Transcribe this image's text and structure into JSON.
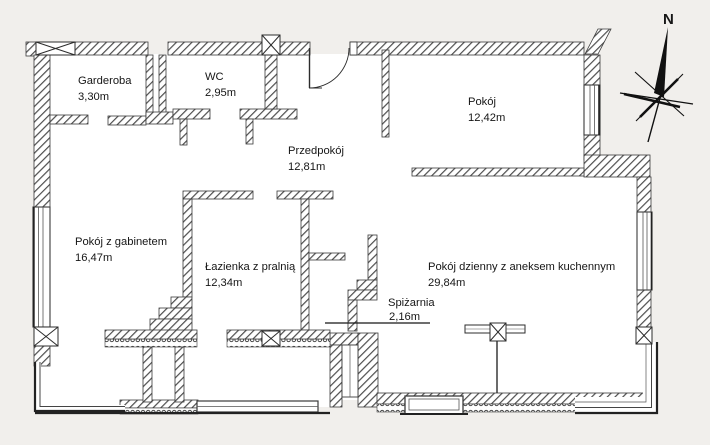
{
  "page": {
    "background": "#f1efec",
    "type": "apartment floor plan"
  },
  "compass": {
    "label": "N"
  },
  "rooms": [
    {
      "name": "Garderoba",
      "area": "3,30m"
    },
    {
      "name": "WC",
      "area": "2,95m"
    },
    {
      "name": "Pokój",
      "area": "12,42m"
    },
    {
      "name": "Przedpokój",
      "area": "12,81m"
    },
    {
      "name": "Pokój z gabinetem",
      "area": "16,47m"
    },
    {
      "name": "Łazienka z pralnią",
      "area": "12,34m"
    },
    {
      "name": "Pokój dzienny z aneksem kuchennym",
      "area": "29,84m"
    },
    {
      "name": "Spiżarnia",
      "area": "2,16m"
    }
  ],
  "colors": {
    "wall_line": "#3b3b3b",
    "hatch": "#4d4d4d",
    "text": "#161616",
    "paper": "#f1efec"
  }
}
